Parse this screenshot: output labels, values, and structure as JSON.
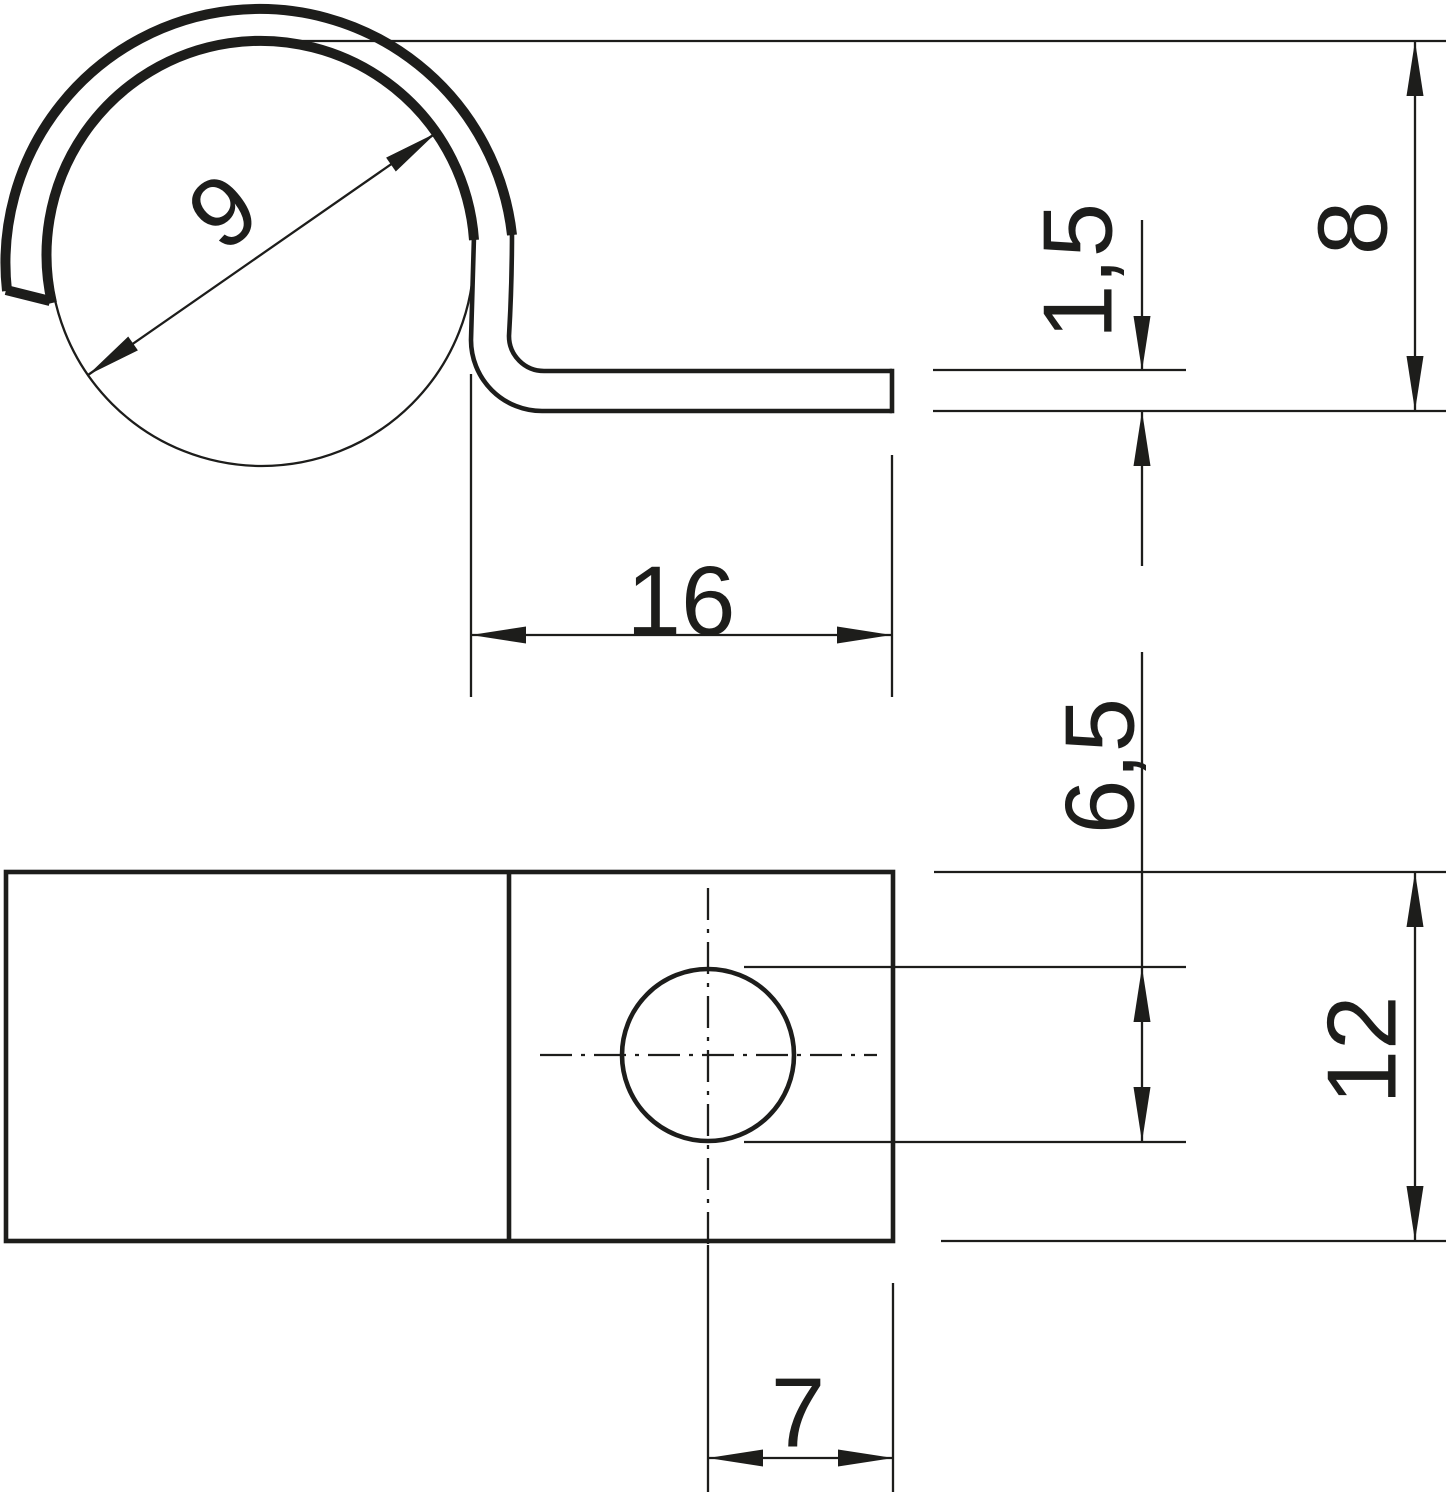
{
  "drawing": {
    "background": "#ffffff",
    "line_color": "#1d1d1b",
    "views": {
      "side_view": "clip profile with clamping loop and flat leg",
      "plan_view": "mounting plate with screw hole"
    },
    "dimensions": {
      "clamping_diameter": "9",
      "leg_length": "16",
      "material_thickness": "1,5",
      "total_height": "8",
      "hole_diameter": "6,5",
      "plate_width": "12",
      "hole_to_end": "7"
    }
  }
}
